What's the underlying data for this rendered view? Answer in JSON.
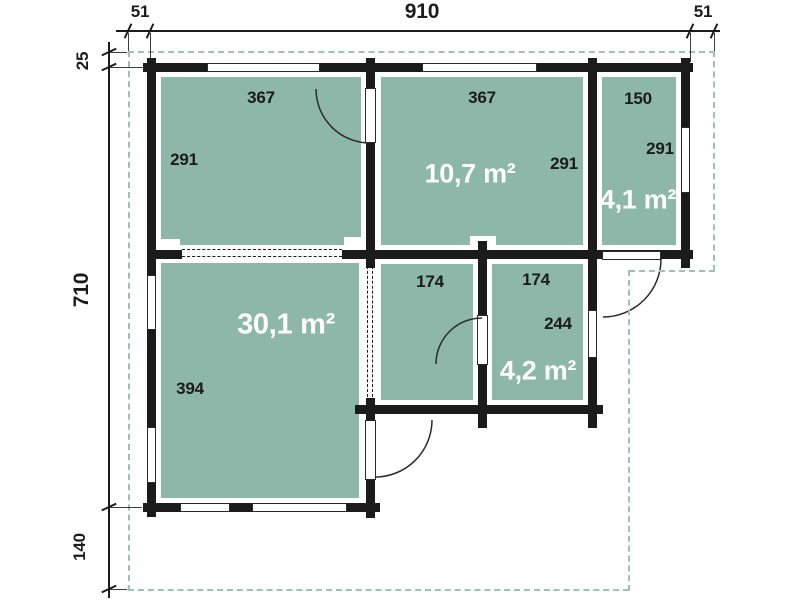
{
  "colors": {
    "room_fill": "#8cb7a9",
    "wall": "#1b1b1b",
    "dash_outline": "#9fc0b5",
    "dim_text": "#1b1b1b",
    "area_text": "#ffffff",
    "background": "#ffffff"
  },
  "dimensions": {
    "overhang_left": "51",
    "overall_width": "910",
    "overhang_right": "51",
    "overhang_top": "25",
    "overall_height": "710",
    "terrace_depth": "140"
  },
  "rooms": {
    "top_left": {
      "width": "367",
      "height": "291"
    },
    "top_middle": {
      "width": "367",
      "height": "291",
      "area": "10,7 m²"
    },
    "top_right": {
      "width": "150",
      "height": "291",
      "area": "4,1 m²"
    },
    "bottom_left": {
      "height": "394",
      "area": "30,1 m²"
    },
    "bottom_middle": {
      "width": "174"
    },
    "bottom_right": {
      "width": "174",
      "height": "244",
      "area": "4,2 m²"
    }
  }
}
